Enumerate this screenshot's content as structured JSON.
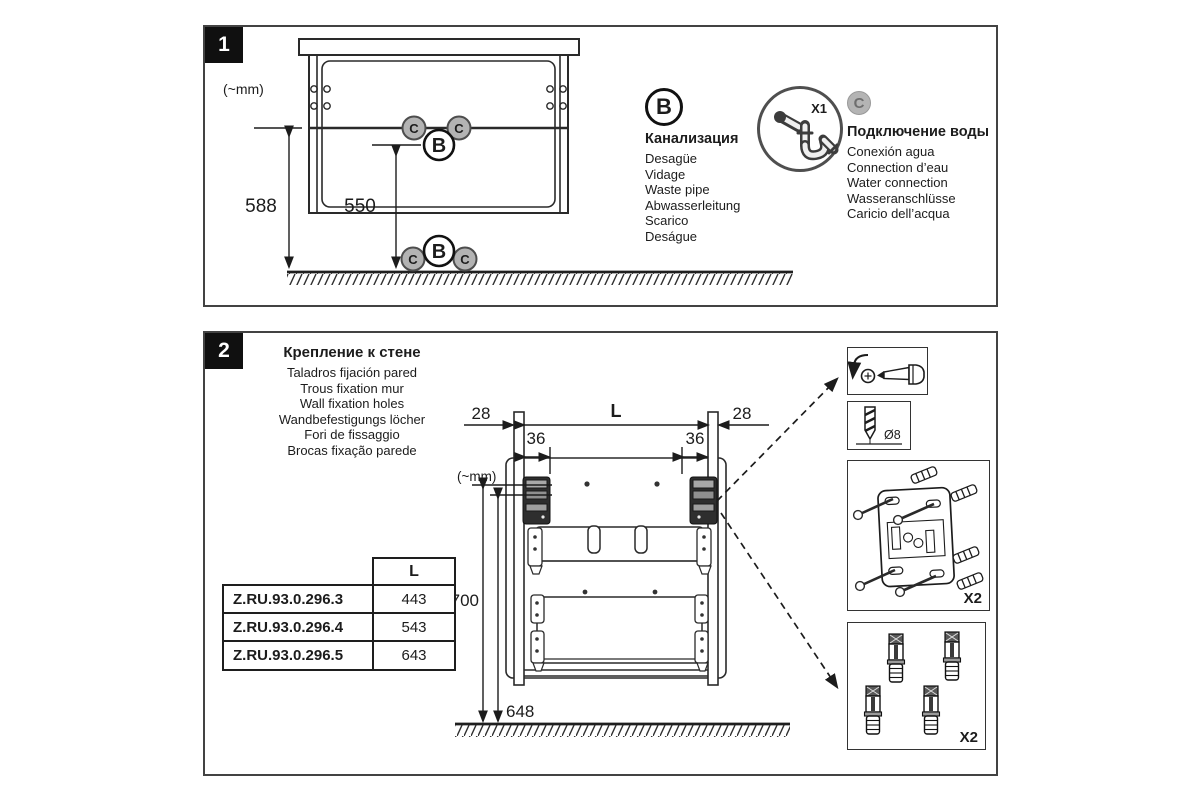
{
  "step1": {
    "number": "1",
    "units_label": "(~mm)",
    "marker_b": "B",
    "marker_c": "C",
    "dims": {
      "floor_to_outlet": "588",
      "floor_to_drain": "550"
    },
    "legend_b": {
      "letter": "B",
      "title": "Канализация",
      "lines": [
        "Desagüe",
        "Vidage",
        "Waste pipe",
        "Abwasserleitung",
        "Scarico",
        "Deságue"
      ]
    },
    "siphon_count": "X1",
    "legend_c": {
      "letter": "C",
      "title": "Подключение воды",
      "lines": [
        "Conexión agua",
        "Connection d’eau",
        "Water connection",
        "Wasseranschlüsse",
        "Caricio dell’acqua"
      ]
    }
  },
  "step2": {
    "number": "2",
    "title": "Крепление к стене",
    "subtitle_lines": [
      "Taladros fijación pared",
      "Trous fixation mur",
      "Wall fixation holes",
      "Wandbefestigungs löcher",
      "Fori de fissaggio",
      "Brocas fixação parede"
    ],
    "units_label": "(~mm)",
    "dims": {
      "left_offset": "28",
      "right_offset": "28",
      "left_inset": "36",
      "right_inset": "36",
      "length_label": "L",
      "top_hole_height": "700",
      "bottom_hole_height": "648"
    },
    "table": {
      "header": "L",
      "rows": [
        {
          "model": "Z.RU.93.0.296.3",
          "length": "443"
        },
        {
          "model": "Z.RU.93.0.296.4",
          "length": "543"
        },
        {
          "model": "Z.RU.93.0.296.5",
          "length": "643"
        }
      ]
    },
    "details": {
      "drill_diameter": "Ø8",
      "bracket_qty": "X2",
      "plug_qty": "X2"
    }
  }
}
